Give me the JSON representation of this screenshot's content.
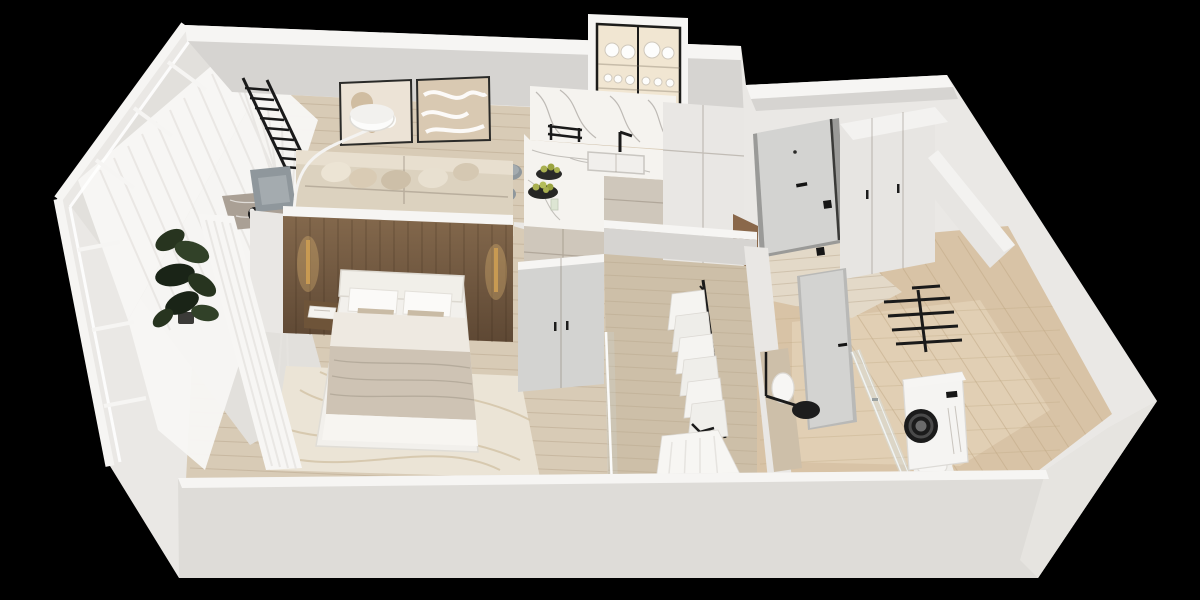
{
  "scene": {
    "description": "Photorealistic 3D isometric cutaway render of a one-bedroom apartment floor plan, viewed from above on a black background",
    "view": "axonometric top-down cutaway",
    "background_note": "pure black surround, white cut walls"
  },
  "colors": {
    "bg": "#000000",
    "wallWhite": "#eae8e5",
    "wallCap": "#f6f5f3",
    "wallGray": "#d6d4d1",
    "wallGrayDark": "#c8c6c3",
    "bottomWall": "#dedcd8",
    "bevelWall": "#e6e4e0",
    "woodFloor": "#d8cbb6",
    "woodFloorDark": "#cdbfa8",
    "plank": "#b8a68c",
    "travWall": "#d8c3a6",
    "travFloor": "#e1cfb4",
    "travLine": "#bfa884",
    "woodWallLight": "#82674b",
    "woodWallDark": "#5e4834",
    "marble": "#f5f3ef",
    "marbleGray": "#aaa095",
    "marbleVein": "#8f8b85",
    "cabinet": "#cfc7bb",
    "cabinetDark": "#c1b9ad",
    "pantry": "#e9e7e4",
    "sofa": "#dcd2bf",
    "sofaLight": "#e8dfcf",
    "pillowTaupe": "#c9bba5",
    "chairGray": "#8f979c",
    "chairGrayLight": "#a4abaf",
    "bedWhite": "#f2f0ec",
    "blanket": "#cec3b4",
    "sheet": "#f7f5f1",
    "rug": "#ebe4d6",
    "rugLine": "#d2c2a5",
    "door": "#d3d3d1",
    "glass": "#d7dede",
    "black": "#1a1a1a",
    "gold": "#c89a52",
    "glow": "#f0c27a",
    "plant": "#27341f",
    "plantMid": "#314128",
    "plantDark": "#1a2417",
    "washer": "#f5f4f2",
    "curtain": "#f7f6f4",
    "curtainShade": "#e6e4e0",
    "wardrobe": "#e7e5e2",
    "wardrobeTop": "#f3f2f0",
    "benchWood": "#8a684a",
    "nightstand": "#6e5439",
    "fruit": "#a9b050"
  },
  "rooms": [
    {
      "name": "balcony",
      "items": [
        "glazed-facade",
        "sheer-curtains",
        "potted-ficus-plant"
      ]
    },
    {
      "name": "living-room",
      "items": [
        "beige-sofa",
        "throw-pillows",
        "wall-bars-ladder",
        "framed-abstract-art",
        "arc-floor-lamp",
        "gray-armchair",
        "marble-console-table",
        "dining-stools"
      ]
    },
    {
      "name": "kitchen",
      "items": [
        "marble-backsplash",
        "glass-display-cabinet",
        "dishware",
        "sink",
        "black-faucet",
        "beige-base-cabinets",
        "marble-bar-counter",
        "fruit-bowls",
        "tall-pantry-cabinet"
      ]
    },
    {
      "name": "entry-hall",
      "items": [
        "front-door",
        "wall-switches",
        "large-white-wardrobe",
        "wood-bench"
      ]
    },
    {
      "name": "bedroom",
      "items": [
        "double-bed",
        "wood-headboard-wall",
        "gold-sconces",
        "floating-nightstand",
        "cream-rug",
        "sheer-curtain",
        "corner-wardrobe"
      ]
    },
    {
      "name": "walk-in-closet",
      "items": [
        "clothes-rail",
        "white-garments",
        "hanging-dress",
        "glass-partition"
      ]
    },
    {
      "name": "bathroom",
      "items": [
        "travertine-tiles",
        "bathroom-door",
        "black-towel-rail",
        "washing-machine",
        "shower-glass-panel",
        "black-shower-head",
        "round-sink-vanity",
        "toilet"
      ]
    }
  ]
}
